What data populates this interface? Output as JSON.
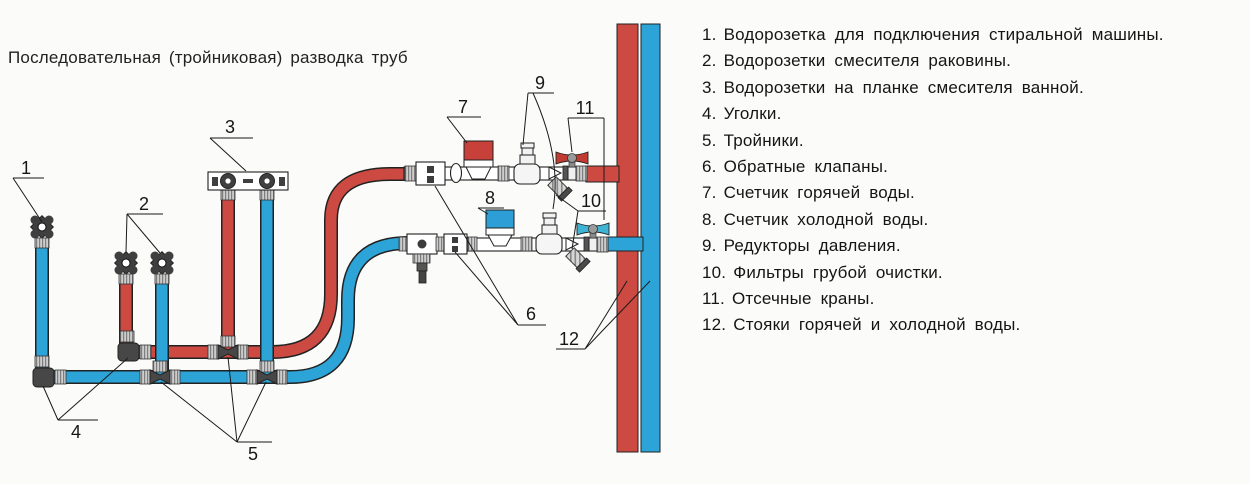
{
  "title": "Последовательная (тройниковая) разводка труб",
  "legend": {
    "items": [
      {
        "num": "1.",
        "text": "Водорозетка для подключения стиральной машины."
      },
      {
        "num": "2.",
        "text": "Водорозетки смесителя раковины."
      },
      {
        "num": "3.",
        "text": "Водорозетки на планке смесителя ванной."
      },
      {
        "num": "4.",
        "text": "Уголки."
      },
      {
        "num": "5.",
        "text": "Тройники."
      },
      {
        "num": "6.",
        "text": "Обратные клапаны."
      },
      {
        "num": "7.",
        "text": "Счетчик горячей воды."
      },
      {
        "num": "8.",
        "text": "Счетчик холодной воды."
      },
      {
        "num": "9.",
        "text": "Редукторы давления."
      },
      {
        "num": "10.",
        "text": "Фильтры грубой очистки."
      },
      {
        "num": "11.",
        "text": "Отсечные краны."
      },
      {
        "num": "12.",
        "text": "Стояки горячей и холодной воды."
      }
    ]
  },
  "diagram": {
    "callouts": {
      "c1": "1",
      "c2": "2",
      "c3": "3",
      "c4": "4",
      "c5": "5",
      "c6": "6",
      "c7": "7",
      "c8": "8",
      "c9": "9",
      "c10": "10",
      "c11": "11",
      "c12": "12"
    },
    "colors": {
      "hot": "#cc4a42",
      "cold": "#2da4d8",
      "hot_handle": "#c23b33",
      "cold_handle": "#3fb3d4",
      "meter_hot": "#c8403a",
      "meter_cold": "#2d9fd6",
      "fitting_dark": "#474747",
      "outline": "#1f1f1f"
    }
  }
}
